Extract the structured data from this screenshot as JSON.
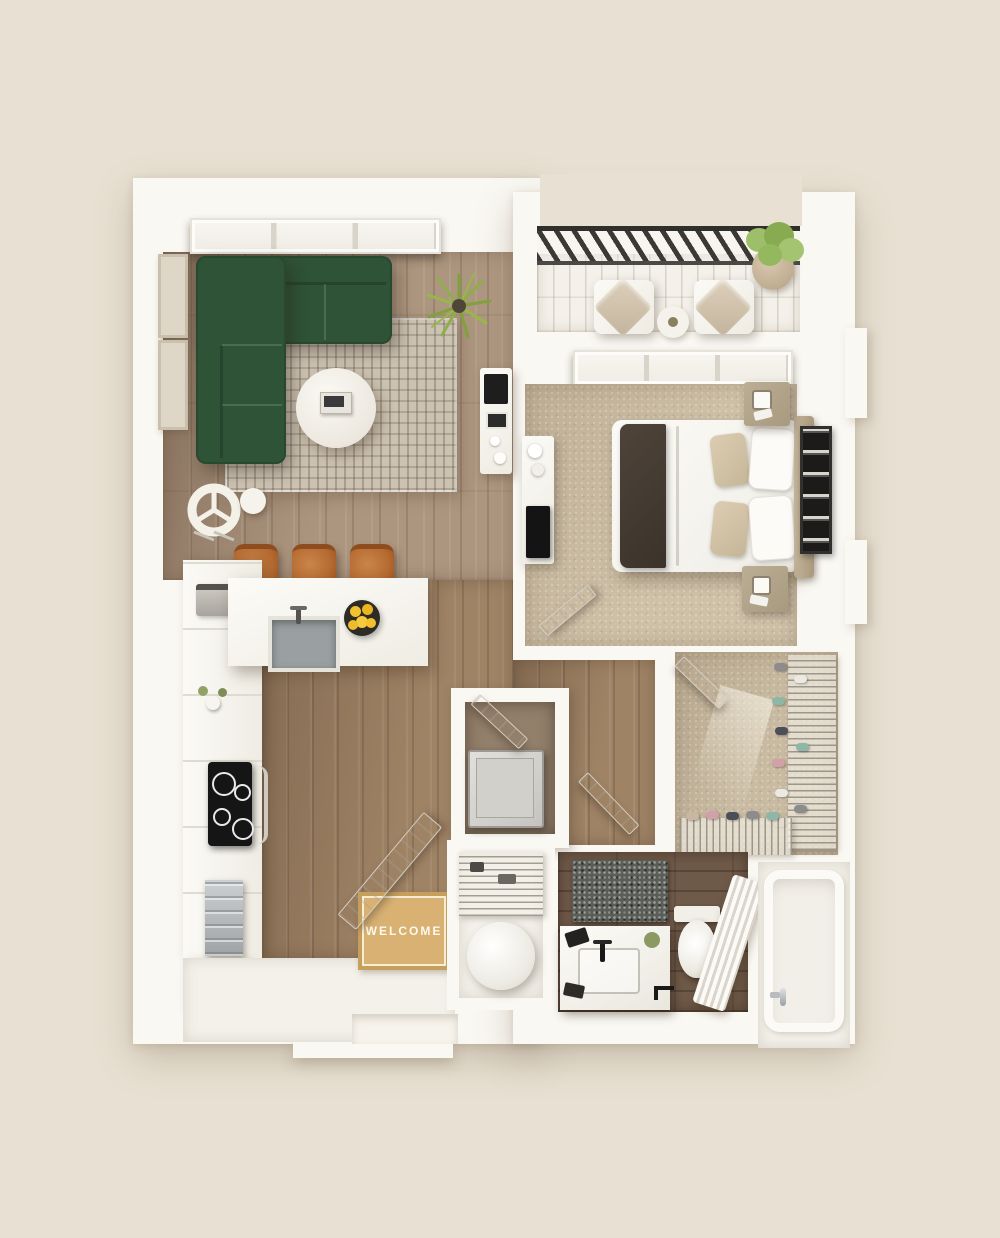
{
  "meta": {
    "description": "Top-down 3D render of a one-bedroom apartment floor plan",
    "view": "top-down",
    "scene_type": "3d-floor-plan"
  },
  "palette": {
    "background": "#e8e1d3",
    "walls": "#faf8f3",
    "living_wood_floor": "#ad967f",
    "hall_wood_floor": "#9f8365",
    "bedroom_carpet": "#cfc1a8",
    "closet_carpet": "#c9bba2",
    "bathroom_tile": "#6f5948",
    "balcony_deck": "#f4f1ea",
    "sofa_green": "#2f5337",
    "area_rug": "#ccc2b2",
    "stool_leather": "#b66b31",
    "plant_green": "#8fae47",
    "balcony_railing": "#3b3935",
    "welcome_mat": "#d8b173",
    "bed_linen": "#f8f7f3",
    "bed_throw": "#453b31",
    "headboard_wood": "#b8a98f",
    "appliance_steel": "#babec0",
    "cooktop_black": "#151515",
    "fruit_yellow": "#f2c12e",
    "shoe_colors": [
      "#8fb7a8",
      "#d39fa8",
      "#8c8c8c",
      "#ece9e2",
      "#4a4f5a",
      "#c9b7a2"
    ]
  },
  "entry": {
    "welcome_mat_text": "WELCOME"
  },
  "rooms": [
    {
      "id": "living-room",
      "floor": "wood"
    },
    {
      "id": "kitchen",
      "floor": "wood"
    },
    {
      "id": "balcony",
      "floor": "deck"
    },
    {
      "id": "bedroom",
      "floor": "carpet"
    },
    {
      "id": "walk-in-closet",
      "floor": "carpet"
    },
    {
      "id": "hallway",
      "floor": "wood"
    },
    {
      "id": "bathroom",
      "floor": "dark-tile"
    },
    {
      "id": "tub-room",
      "floor": "white"
    },
    {
      "id": "utility-closet",
      "floor": "white"
    },
    {
      "id": "entryway",
      "floor": "white"
    }
  ],
  "objects": {
    "living_room": [
      "green-sectional-sofa",
      "patterned-area-rug",
      "round-coffee-table",
      "book-stack",
      "floor-plant",
      "accent-chair",
      "side-table",
      "wall-frames",
      "desk-with-laptop",
      "triple-window"
    ],
    "kitchen": [
      "l-shaped-counter",
      "undermount-sink",
      "faucet",
      "fruit-bowl",
      "bar-stools",
      "tall-cabinets",
      "cooktop",
      "oven",
      "dishwasher",
      "flower-vase",
      "base-cabinet"
    ],
    "balcony": [
      "railing",
      "lounge-chairs",
      "bistro-table",
      "potted-plant"
    ],
    "bedroom": [
      "double-bed",
      "dark-throw-blanket",
      "pillows",
      "headboard",
      "nightstands",
      "wall-art",
      "dresser-with-tv",
      "window",
      "open-door"
    ],
    "closet": [
      "wire-shoe-racks",
      "shoes",
      "open-door"
    ],
    "bathroom": [
      "vanity-with-sink",
      "black-faucet",
      "bath-mat",
      "toilet",
      "toilet-paper-holder",
      "towel-ladder",
      "open-door"
    ],
    "tub_room": [
      "bathtub",
      "tub-faucet"
    ],
    "utility": [
      "washing-machine",
      "laundry-nook",
      "wire-shelf",
      "water-heater"
    ],
    "entry": [
      "welcome-mat",
      "open-front-door",
      "threshold"
    ]
  }
}
